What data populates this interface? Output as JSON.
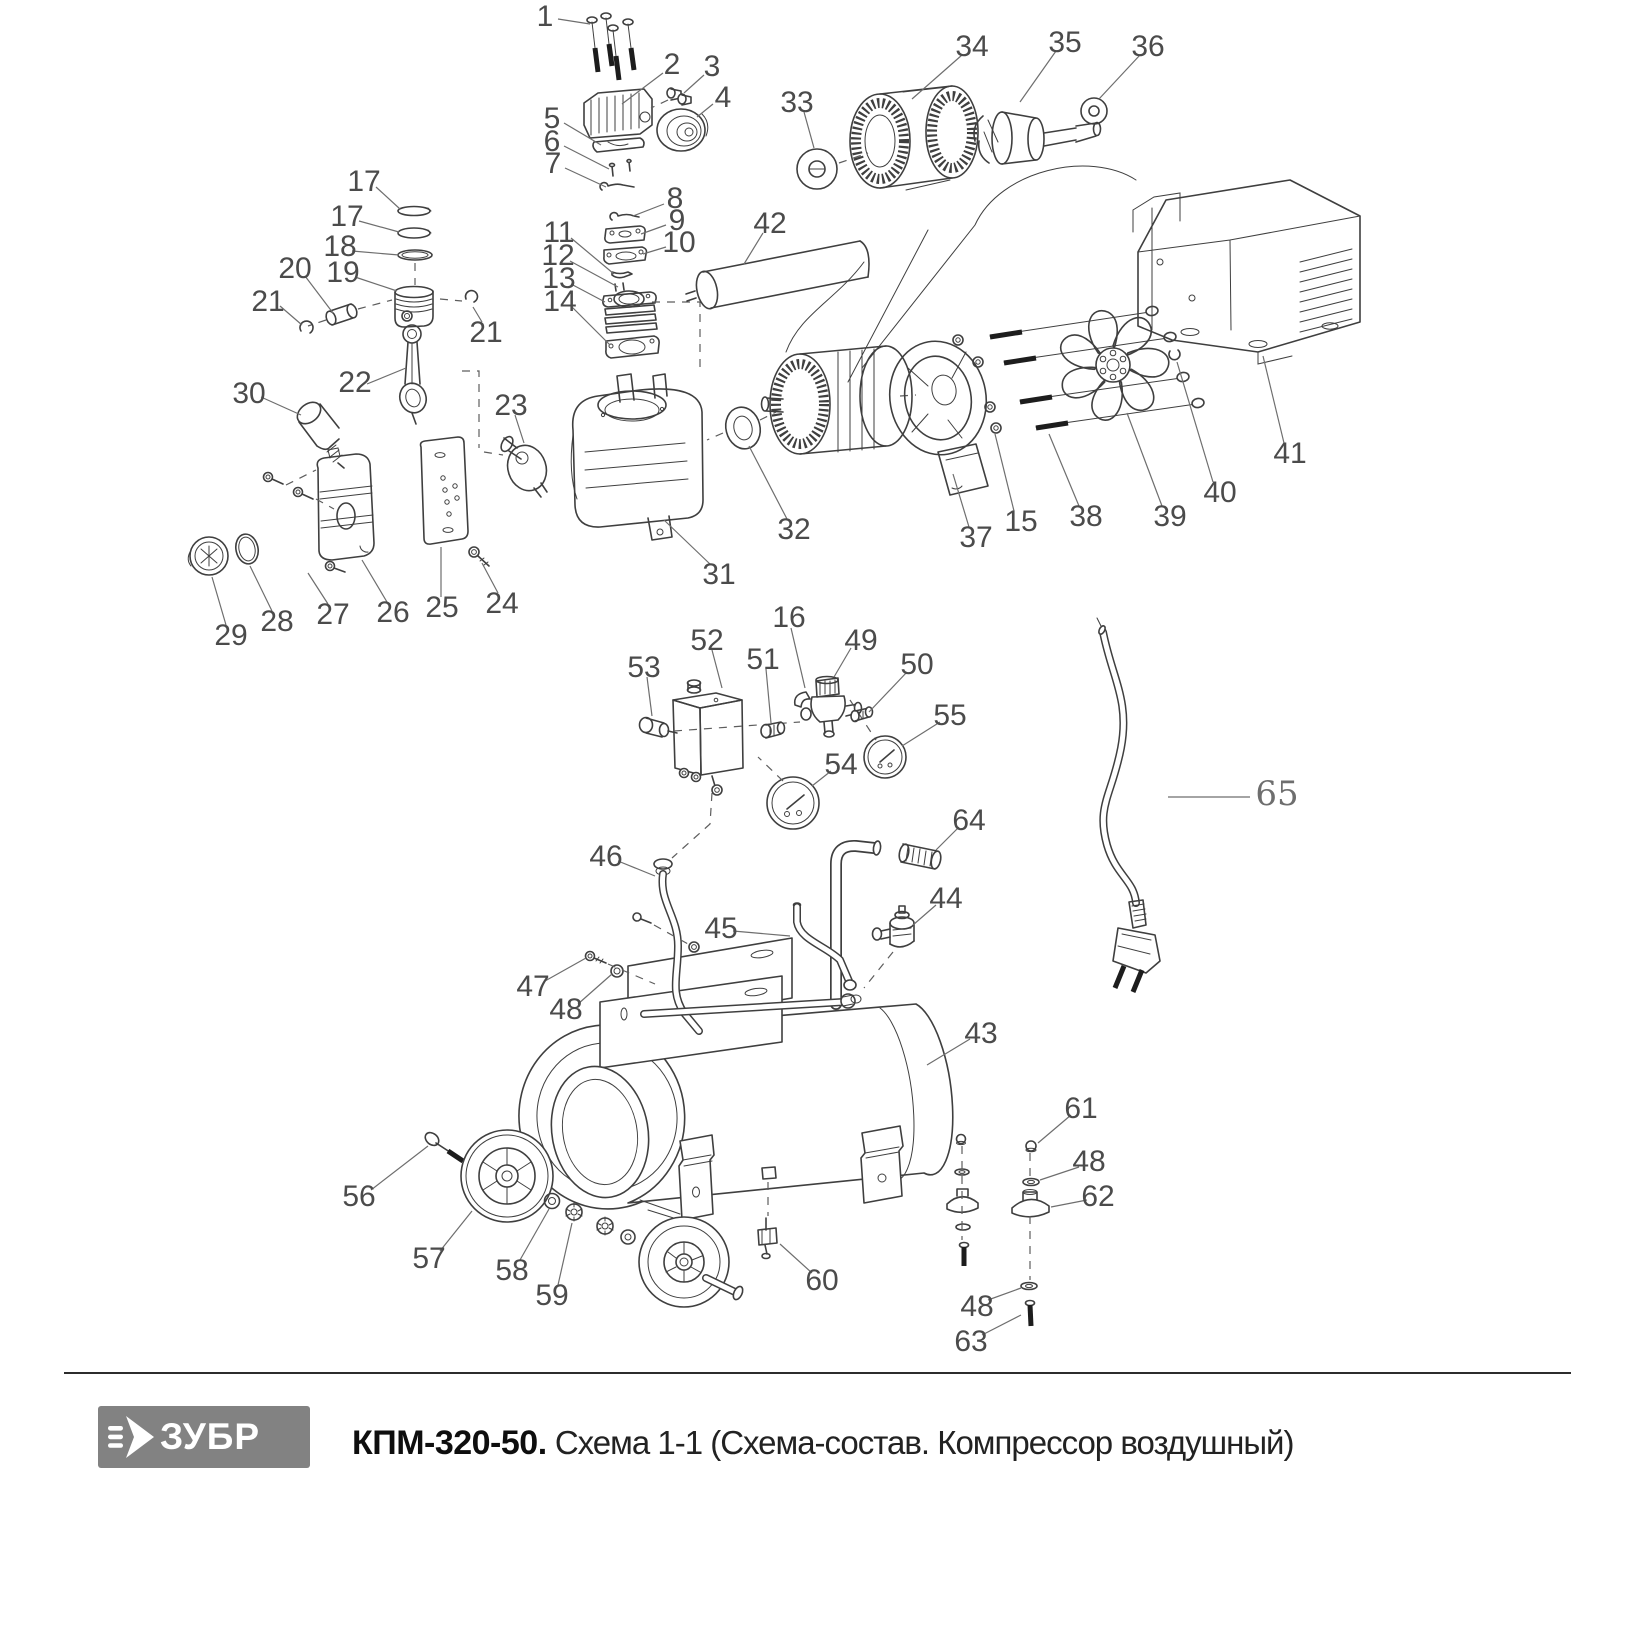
{
  "footer": {
    "logo_text": "ЗУБР",
    "title_bold": "КПМ-320-50.",
    "title_regular": " Схема 1-1 (Схема-состав. Компрессор воздушный)",
    "logo_bg": "#828282",
    "divider_color": "#2c2c2c"
  },
  "diagram": {
    "stroke_color": "#3f3f3f",
    "label_color": "#4b4b4b",
    "leader_color": "#6e6e6e",
    "callouts": [
      {
        "n": "1",
        "x": 545,
        "y": 16,
        "sx": 558,
        "sy": 19,
        "ex": 590,
        "ey": 24
      },
      {
        "n": "2",
        "x": 672,
        "y": 64,
        "sx": 663,
        "sy": 73,
        "ex": 622,
        "ey": 104
      },
      {
        "n": "3",
        "x": 712,
        "y": 66,
        "sx": 704,
        "sy": 75,
        "ex": 684,
        "ey": 93
      },
      {
        "n": "4",
        "x": 723,
        "y": 97,
        "sx": 713,
        "sy": 104,
        "ex": 697,
        "ey": 117
      },
      {
        "n": "5",
        "x": 552,
        "y": 118,
        "sx": 564,
        "sy": 123,
        "ex": 601,
        "ey": 145
      },
      {
        "n": "6",
        "x": 552,
        "y": 141,
        "sx": 564,
        "sy": 146,
        "ex": 609,
        "ey": 169
      },
      {
        "n": "7",
        "x": 553,
        "y": 163,
        "sx": 565,
        "sy": 168,
        "ex": 606,
        "ey": 187
      },
      {
        "n": "8",
        "x": 675,
        "y": 198,
        "sx": 664,
        "sy": 204,
        "ex": 633,
        "ey": 216
      },
      {
        "n": "9",
        "x": 677,
        "y": 220,
        "sx": 666,
        "sy": 225,
        "ex": 641,
        "ey": 234
      },
      {
        "n": "10",
        "x": 679,
        "y": 242,
        "sx": 666,
        "sy": 247,
        "ex": 643,
        "ey": 254
      },
      {
        "n": "11",
        "x": 559,
        "y": 232,
        "sx": 571,
        "sy": 238,
        "ex": 614,
        "ey": 274
      },
      {
        "n": "12",
        "x": 558,
        "y": 255,
        "sx": 570,
        "sy": 261,
        "ex": 618,
        "ey": 287
      },
      {
        "n": "13",
        "x": 559,
        "y": 278,
        "sx": 571,
        "sy": 284,
        "ex": 605,
        "ey": 302
      },
      {
        "n": "14",
        "x": 560,
        "y": 301,
        "sx": 572,
        "sy": 307,
        "ex": 610,
        "ey": 345
      },
      {
        "n": "17",
        "x": 364,
        "y": 181,
        "sx": 376,
        "sy": 187,
        "ex": 400,
        "ey": 209
      },
      {
        "n": "17",
        "x": 347,
        "y": 216,
        "sx": 359,
        "sy": 221,
        "ex": 399,
        "ey": 232
      },
      {
        "n": "18",
        "x": 340,
        "y": 246,
        "sx": 352,
        "sy": 251,
        "ex": 399,
        "ey": 255
      },
      {
        "n": "19",
        "x": 343,
        "y": 272,
        "sx": 355,
        "sy": 277,
        "ex": 397,
        "ey": 291
      },
      {
        "n": "20",
        "x": 295,
        "y": 268,
        "sx": 305,
        "sy": 276,
        "ex": 333,
        "ey": 313
      },
      {
        "n": "21",
        "x": 268,
        "y": 301,
        "sx": 280,
        "sy": 306,
        "ex": 302,
        "ey": 325
      },
      {
        "n": "21",
        "x": 486,
        "y": 332,
        "sx": 482,
        "sy": 322,
        "ex": 473,
        "ey": 307
      },
      {
        "n": "22",
        "x": 355,
        "y": 382,
        "sx": 367,
        "sy": 384,
        "ex": 406,
        "ey": 368
      },
      {
        "n": "23",
        "x": 511,
        "y": 405,
        "sx": 515,
        "sy": 415,
        "ex": 524,
        "ey": 443
      },
      {
        "n": "24",
        "x": 502,
        "y": 603,
        "sx": 498,
        "sy": 593,
        "ex": 482,
        "ey": 563
      },
      {
        "n": "25",
        "x": 442,
        "y": 607,
        "sx": 441,
        "sy": 597,
        "ex": 441,
        "ey": 547
      },
      {
        "n": "26",
        "x": 393,
        "y": 612,
        "sx": 387,
        "sy": 602,
        "ex": 362,
        "ey": 560
      },
      {
        "n": "27",
        "x": 333,
        "y": 614,
        "sx": 328,
        "sy": 604,
        "ex": 308,
        "ey": 573
      },
      {
        "n": "28",
        "x": 277,
        "y": 621,
        "sx": 272,
        "sy": 611,
        "ex": 250,
        "ey": 566
      },
      {
        "n": "29",
        "x": 231,
        "y": 635,
        "sx": 226,
        "sy": 625,
        "ex": 212,
        "ey": 577
      },
      {
        "n": "30",
        "x": 249,
        "y": 393,
        "sx": 261,
        "sy": 397,
        "ex": 301,
        "ey": 415
      },
      {
        "n": "31",
        "x": 719,
        "y": 574,
        "sx": 711,
        "sy": 565,
        "ex": 664,
        "ey": 520
      },
      {
        "n": "32",
        "x": 794,
        "y": 529,
        "sx": 787,
        "sy": 519,
        "ex": 749,
        "ey": 446
      },
      {
        "n": "33",
        "x": 797,
        "y": 102,
        "sx": 804,
        "sy": 112,
        "ex": 814,
        "ey": 148
      },
      {
        "n": "34",
        "x": 972,
        "y": 46,
        "sx": 962,
        "sy": 55,
        "ex": 912,
        "ey": 99
      },
      {
        "n": "35",
        "x": 1065,
        "y": 42,
        "sx": 1056,
        "sy": 51,
        "ex": 1020,
        "ey": 102
      },
      {
        "n": "36",
        "x": 1148,
        "y": 46,
        "sx": 1140,
        "sy": 55,
        "ex": 1099,
        "ey": 99
      },
      {
        "n": "37",
        "x": 976,
        "y": 537,
        "sx": 969,
        "sy": 527,
        "ex": 953,
        "ey": 474
      },
      {
        "n": "15",
        "x": 1021,
        "y": 521,
        "sx": 1014,
        "sy": 511,
        "ex": 995,
        "ey": 434
      },
      {
        "n": "38",
        "x": 1086,
        "y": 516,
        "sx": 1079,
        "sy": 506,
        "ex": 1049,
        "ey": 434
      },
      {
        "n": "39",
        "x": 1170,
        "y": 516,
        "sx": 1162,
        "sy": 506,
        "ex": 1127,
        "ey": 413
      },
      {
        "n": "40",
        "x": 1220,
        "y": 492,
        "sx": 1213,
        "sy": 482,
        "ex": 1177,
        "ey": 362
      },
      {
        "n": "41",
        "x": 1290,
        "y": 453,
        "sx": 1284,
        "sy": 443,
        "ex": 1263,
        "ey": 356
      },
      {
        "n": "42",
        "x": 770,
        "y": 223,
        "sx": 763,
        "sy": 233,
        "ex": 744,
        "ey": 264
      },
      {
        "n": "16",
        "x": 789,
        "y": 617,
        "sx": 791,
        "sy": 628,
        "ex": 805,
        "ey": 688
      },
      {
        "n": "49",
        "x": 861,
        "y": 640,
        "sx": 851,
        "sy": 648,
        "ex": 834,
        "ey": 677
      },
      {
        "n": "50",
        "x": 917,
        "y": 664,
        "sx": 907,
        "sy": 672,
        "ex": 869,
        "ey": 712
      },
      {
        "n": "51",
        "x": 763,
        "y": 659,
        "sx": 766,
        "sy": 669,
        "ex": 771,
        "ey": 723
      },
      {
        "n": "52",
        "x": 707,
        "y": 640,
        "sx": 712,
        "sy": 650,
        "ex": 722,
        "ey": 688
      },
      {
        "n": "53",
        "x": 644,
        "y": 667,
        "sx": 647,
        "sy": 677,
        "ex": 652,
        "ey": 716
      },
      {
        "n": "54",
        "x": 841,
        "y": 764,
        "sx": 831,
        "sy": 771,
        "ex": 812,
        "ey": 786
      },
      {
        "n": "55",
        "x": 950,
        "y": 715,
        "sx": 940,
        "sy": 722,
        "ex": 902,
        "ey": 746
      },
      {
        "n": "64",
        "x": 969,
        "y": 820,
        "sx": 959,
        "sy": 827,
        "ex": 936,
        "ey": 850
      },
      {
        "n": "46",
        "x": 606,
        "y": 856,
        "sx": 618,
        "sy": 861,
        "ex": 655,
        "ey": 876
      },
      {
        "n": "45",
        "x": 721,
        "y": 928,
        "sx": 733,
        "sy": 931,
        "ex": 790,
        "ey": 936
      },
      {
        "n": "44",
        "x": 946,
        "y": 898,
        "sx": 936,
        "sy": 905,
        "ex": 913,
        "ey": 925
      },
      {
        "n": "47",
        "x": 533,
        "y": 986,
        "sx": 545,
        "sy": 981,
        "ex": 586,
        "ey": 958
      },
      {
        "n": "48",
        "x": 566,
        "y": 1009,
        "sx": 578,
        "sy": 1004,
        "ex": 612,
        "ey": 974
      },
      {
        "n": "43",
        "x": 981,
        "y": 1033,
        "sx": 970,
        "sy": 1039,
        "ex": 927,
        "ey": 1065
      },
      {
        "n": "56",
        "x": 359,
        "y": 1196,
        "sx": 371,
        "sy": 1190,
        "ex": 428,
        "ey": 1146
      },
      {
        "n": "57",
        "x": 429,
        "y": 1258,
        "sx": 440,
        "sy": 1251,
        "ex": 472,
        "ey": 1211
      },
      {
        "n": "58",
        "x": 512,
        "y": 1270,
        "sx": 520,
        "sy": 1260,
        "ex": 549,
        "ey": 1209
      },
      {
        "n": "59",
        "x": 552,
        "y": 1295,
        "sx": 558,
        "sy": 1285,
        "ex": 572,
        "ey": 1223
      },
      {
        "n": "60",
        "x": 822,
        "y": 1280,
        "sx": 812,
        "sy": 1273,
        "ex": 780,
        "ey": 1244
      },
      {
        "n": "61",
        "x": 1081,
        "y": 1108,
        "sx": 1071,
        "sy": 1115,
        "ex": 1038,
        "ey": 1143
      },
      {
        "n": "48",
        "x": 1089,
        "y": 1161,
        "sx": 1079,
        "sy": 1167,
        "ex": 1040,
        "ey": 1180
      },
      {
        "n": "62",
        "x": 1098,
        "y": 1196,
        "sx": 1087,
        "sy": 1200,
        "ex": 1051,
        "ey": 1207
      },
      {
        "n": "48",
        "x": 977,
        "y": 1306,
        "sx": 988,
        "sy": 1300,
        "ex": 1021,
        "ey": 1288
      },
      {
        "n": "63",
        "x": 971,
        "y": 1341,
        "sx": 982,
        "sy": 1335,
        "ex": 1021,
        "ey": 1315
      },
      {
        "n": "65",
        "x": 1277,
        "y": 795,
        "serif": true,
        "sx": 1250,
        "sy": 797,
        "ex": 1168,
        "ey": 797
      }
    ]
  }
}
